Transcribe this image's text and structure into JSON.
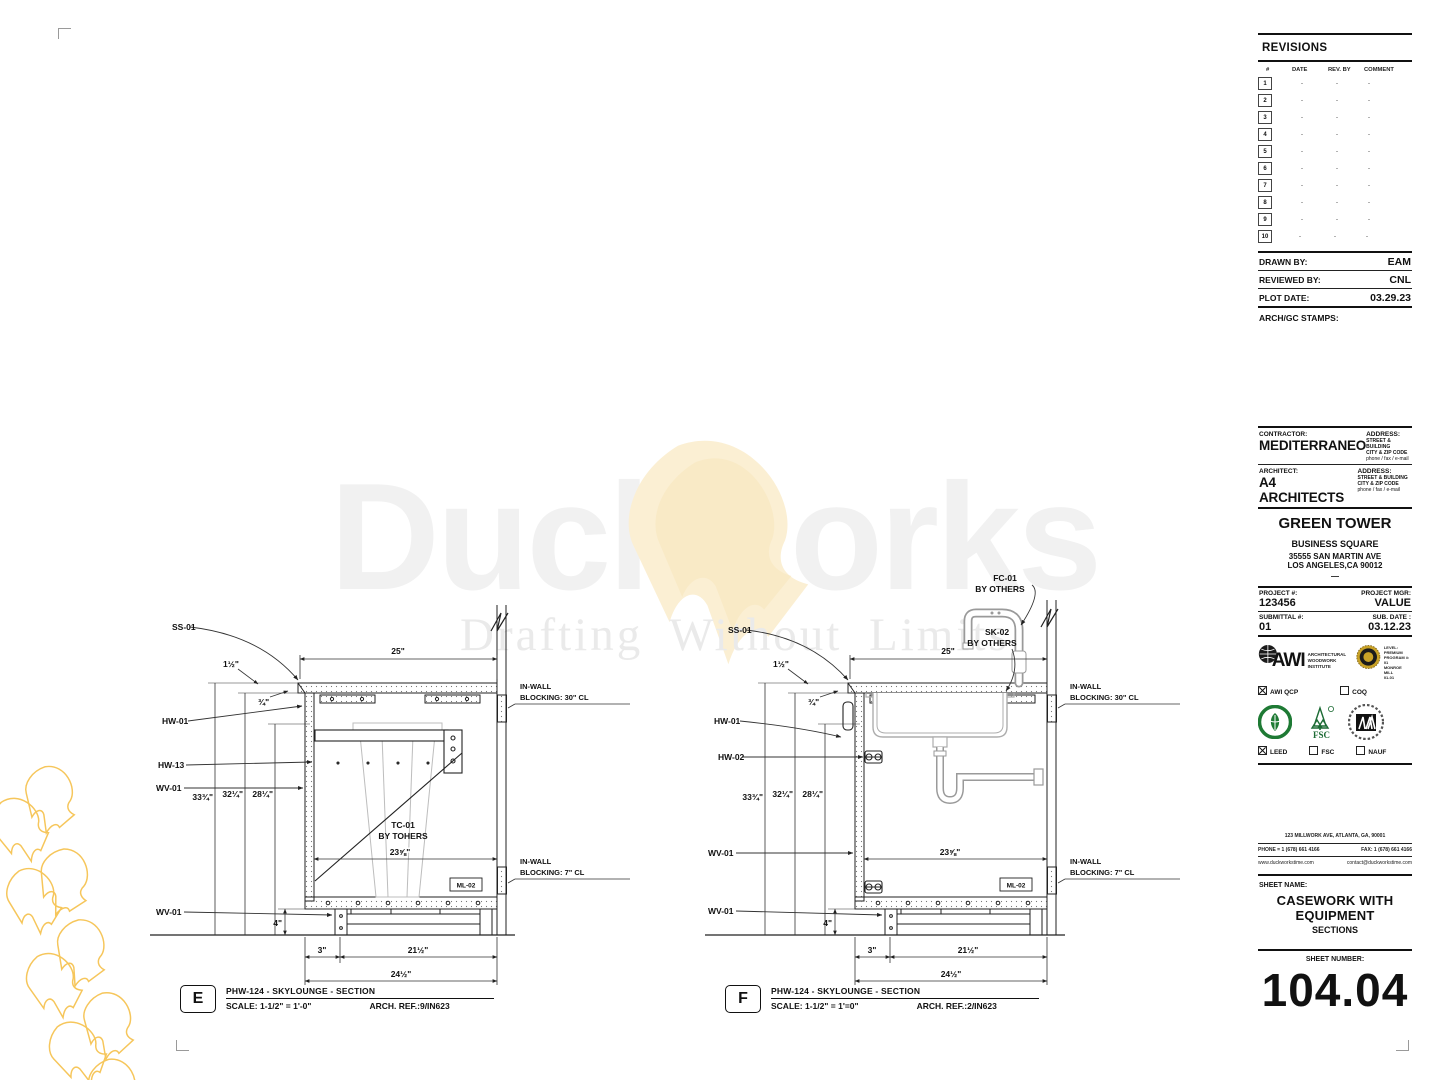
{
  "watermark": {
    "word_left": "Duck",
    "word_right": "orks",
    "tagline": "Drafting Without Limits"
  },
  "drawing_e": {
    "badge": "E",
    "title": "PHW-124 - SKYLOUNGE - SECTION",
    "scale": "SCALE: 1-1/2\" = 1'-0\"",
    "arch_ref": "ARCH. REF.:9/IN623",
    "labels": {
      "ss01": "SS-01",
      "hw01": "HW-01",
      "hw13": "HW-13",
      "wv01_top": "WV-01",
      "wv01_bot": "WV-01",
      "tc01": "TC-01",
      "tc01_sub": "BY TOHERS",
      "ml02": "ML-02"
    },
    "dims": {
      "top": "25\"",
      "overhang": "1½\"",
      "small": "¾\"",
      "v1": "33¾\"",
      "v2": "32¼\"",
      "v3": "28¼\"",
      "inner": "23⅝\"",
      "toe": "4\"",
      "b1": "3\"",
      "b2": "21½\"",
      "b3": "24½\""
    },
    "blocking_top_1": "IN-WALL",
    "blocking_top_2": "BLOCKING:  30\" CL",
    "blocking_bot_1": "IN-WALL",
    "blocking_bot_2": "BLOCKING:  7\" CL"
  },
  "drawing_f": {
    "badge": "F",
    "title": "PHW-124 - SKYLOUNGE - SECTION",
    "scale": "SCALE: 1-1/2\" = 1'=0\"",
    "arch_ref": "ARCH. REF.:2/IN623",
    "labels": {
      "fc01": "FC-01",
      "fc01_sub": "BY OTHERS",
      "sk02": "SK-02",
      "sk02_sub": "BY OTHERS",
      "ss01": "SS-01",
      "hw01": "HW-01",
      "hw02": "HW-02",
      "wv01_top": "WV-01",
      "wv01_bot": "WV-01",
      "ml02": "ML-02"
    },
    "dims": {
      "top": "25\"",
      "overhang": "1½\"",
      "small": "¾\"",
      "v1": "33¾\"",
      "v2": "32¼\"",
      "v3": "28¼\"",
      "inner": "23⅝\"",
      "toe": "4\"",
      "b1": "3\"",
      "b2": "21½\"",
      "b3": "24½\""
    },
    "blocking_top_1": "IN-WALL",
    "blocking_top_2": "BLOCKING:  30\" CL",
    "blocking_bot_1": "IN-WALL",
    "blocking_bot_2": "BLOCKING:  7\" CL"
  },
  "titleblock": {
    "revisions": {
      "title": "REVISIONS",
      "col_num": "#",
      "col_date": "DATE",
      "col_rev": "REV. BY",
      "col_comment": "COMMENT",
      "rows": [
        {
          "n": "1",
          "d": "-",
          "r": "-",
          "c": "-"
        },
        {
          "n": "2",
          "d": "-",
          "r": "-",
          "c": "-"
        },
        {
          "n": "3",
          "d": "-",
          "r": "-",
          "c": "-"
        },
        {
          "n": "4",
          "d": "-",
          "r": "-",
          "c": "-"
        },
        {
          "n": "5",
          "d": "-",
          "r": "-",
          "c": "-"
        },
        {
          "n": "6",
          "d": "-",
          "r": "-",
          "c": "-"
        },
        {
          "n": "7",
          "d": "-",
          "r": "-",
          "c": "-"
        },
        {
          "n": "8",
          "d": "-",
          "r": "-",
          "c": "-"
        },
        {
          "n": "9",
          "d": "-",
          "r": "-",
          "c": "-"
        },
        {
          "n": "10",
          "d": "-",
          "r": "-",
          "c": "-"
        }
      ]
    },
    "drawn_by_label": "DRAWN BY:",
    "drawn_by": "EAM",
    "reviewed_by_label": "REVIEWED BY:",
    "reviewed_by": "CNL",
    "plot_date_label": "PLOT DATE:",
    "plot_date": "03.29.23",
    "stamps_label": "ARCH/GC STAMPS:",
    "contractor_label": "CONTRACTOR:",
    "contractor": "MEDITERRANEO",
    "architect_label": "ARCHITECT:",
    "architect": "A4 ARCHITECTS",
    "address_label": "ADDRESS:",
    "address_line1": "STREET & BUILDING",
    "address_line2": "CITY & ZIP CODE",
    "address_line3": "phone / fax / e-mail",
    "project_name": "GREEN TOWER",
    "project_sub": "BUSINESS SQUARE",
    "project_addr1": "35555 SAN MARTIN AVE",
    "project_addr2": "LOS ANGELES,CA 90012",
    "project_dash": "—",
    "project_no_label": "PROJECT #:",
    "project_no": "123456",
    "project_mgr_label": "PROJECT MGR:",
    "project_mgr": "VALUE",
    "submittal_label": "SUBMITTAL #:",
    "submittal": "01",
    "sub_date_label": "SUB. DATE :",
    "sub_date": "03.12.23",
    "awi_name": "AWI",
    "awi_sub1": "ARCHITECTURAL",
    "awi_sub2": "WOODWORK",
    "awi_sub3": "INSTITUTE",
    "seal_l1": "LEVEL: PREMIUM",
    "seal_l2": "PROGRAM #:",
    "seal_l3": "01",
    "seal_l4": "MONROE MILL",
    "seal_l5": "01-01",
    "check_awi_qcp": "AWI QCP",
    "check_coq": "COQ",
    "check_leed": "LEED",
    "check_fsc": "FSC",
    "check_nauf": "NAUF",
    "fsc_text": "FSC",
    "company_address": "123 MILLWORK AVE, ATLANTA, GA, 90001",
    "company_phone": "PHONE = 1 (678) 661 4166",
    "company_fax": "FAX: 1 (678) 661 4166",
    "company_web": "www.duckworkstime.com",
    "company_email": "contact@duckworkstime.com",
    "sheet_name_label": "SHEET NAME:",
    "sheet_name_1": "CASEWORK WITH",
    "sheet_name_2": "EQUIPMENT",
    "sheet_name_3": "SECTIONS",
    "sheet_number_label": "SHEET NUMBER:",
    "sheet_number": "104.04"
  },
  "colors": {
    "accent_yellow": "#F6C65B",
    "wm_cream": "#FBEFD3",
    "line": "#111111"
  }
}
